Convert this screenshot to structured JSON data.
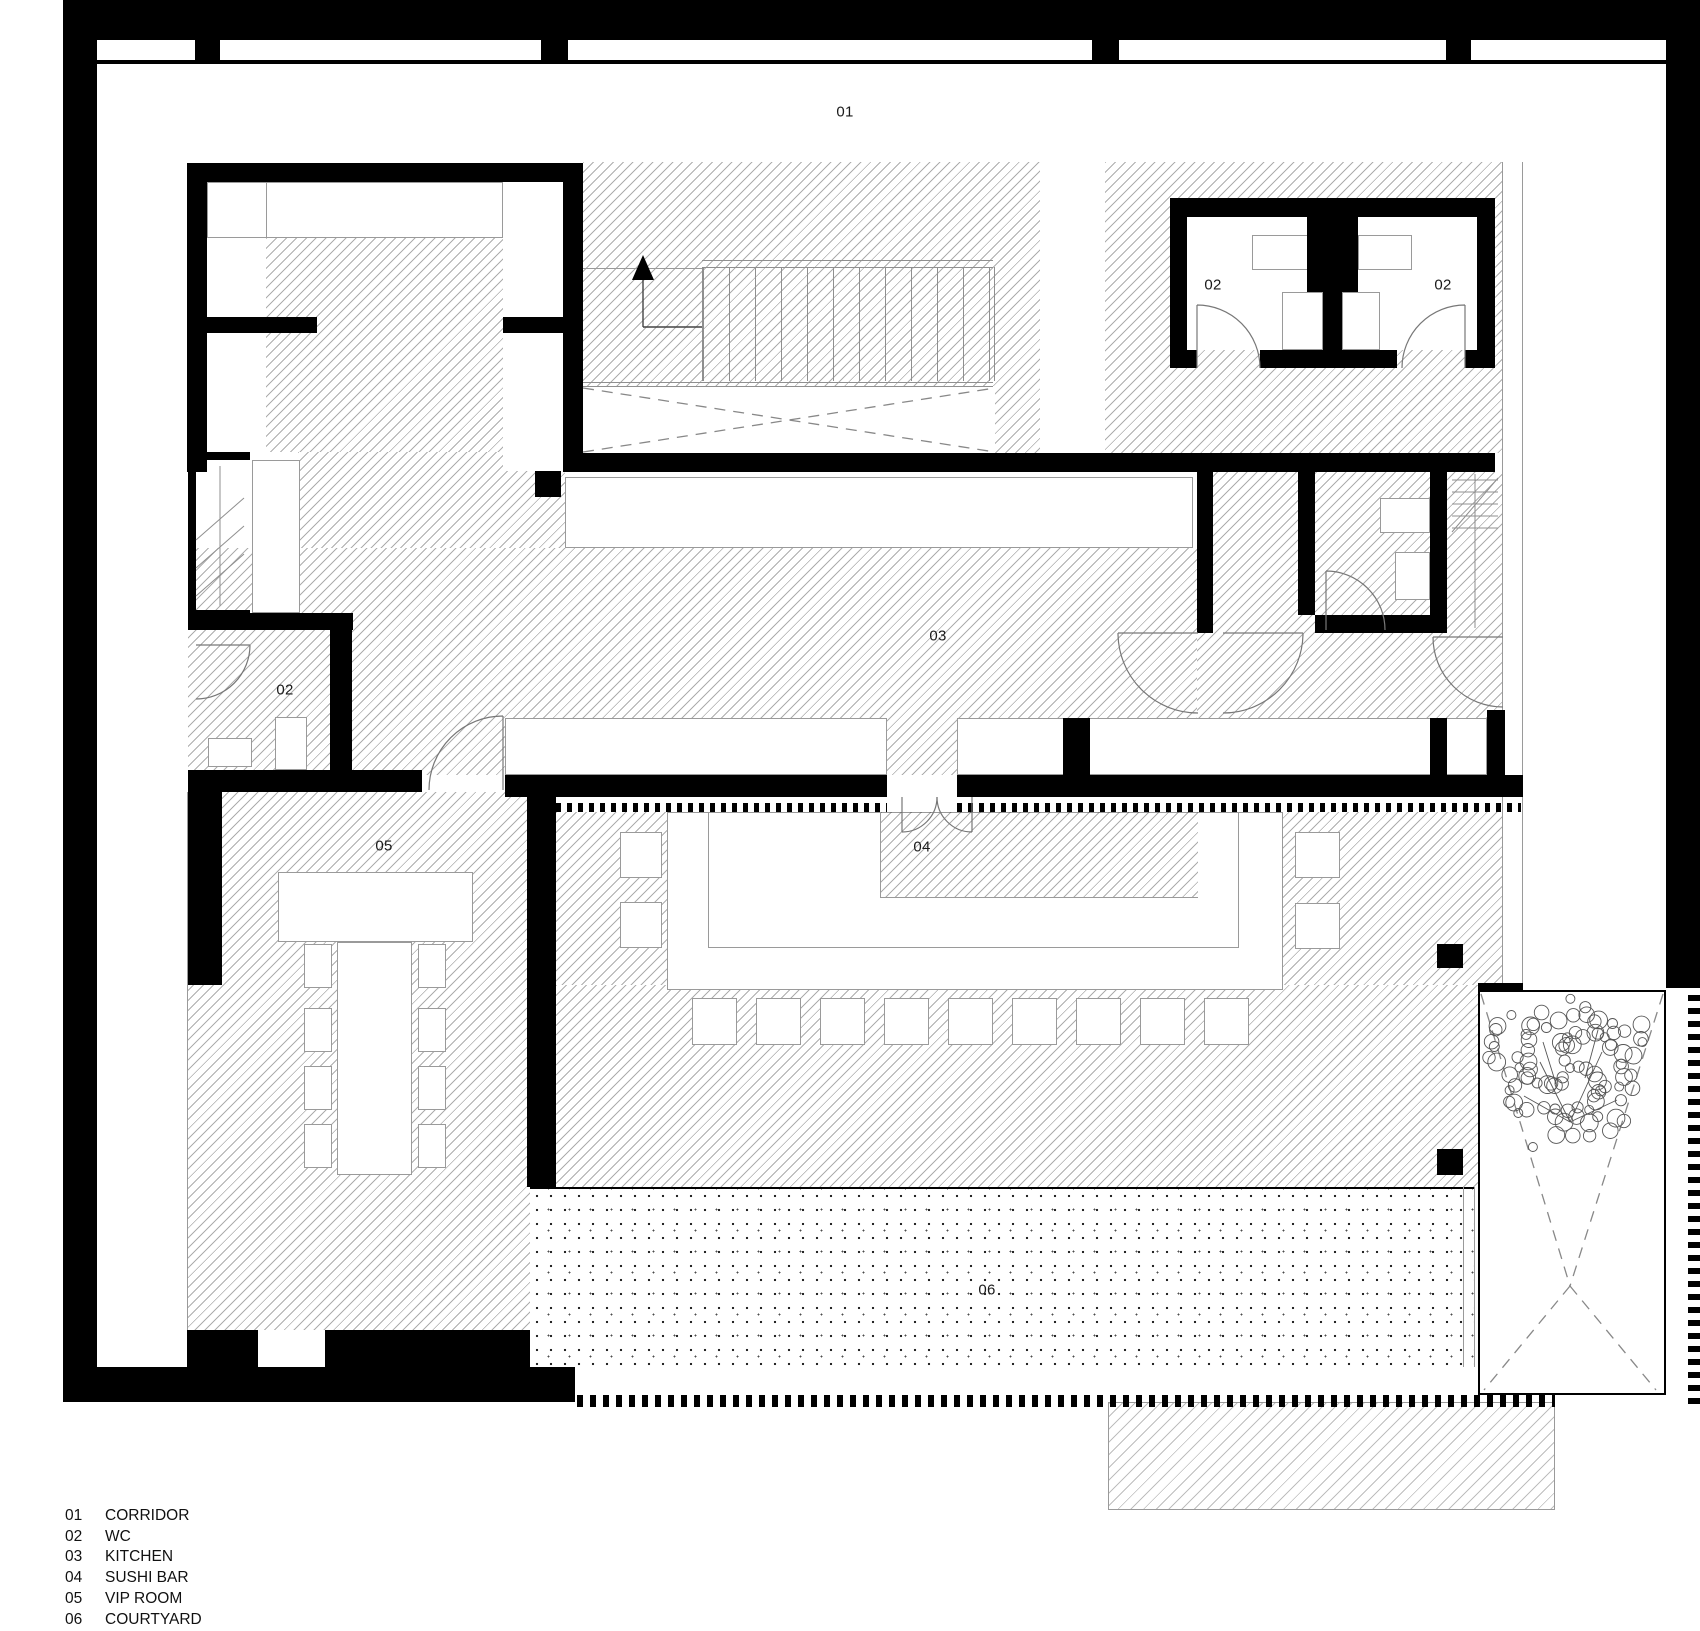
{
  "document": {
    "type": "architectural-floor-plan",
    "plan": {
      "labels": [
        {
          "id": "corridor",
          "text": "01",
          "x": 845,
          "y": 112
        },
        {
          "id": "wc-top-left",
          "text": "02",
          "x": 1213,
          "y": 285
        },
        {
          "id": "wc-top-right",
          "text": "02",
          "x": 1443,
          "y": 285
        },
        {
          "id": "wc-left",
          "text": "02",
          "x": 285,
          "y": 690
        },
        {
          "id": "kitchen",
          "text": "03",
          "x": 938,
          "y": 636
        },
        {
          "id": "sushi-bar",
          "text": "04",
          "x": 922,
          "y": 847
        },
        {
          "id": "vip-room",
          "text": "05",
          "x": 384,
          "y": 846
        },
        {
          "id": "courtyard",
          "text": "06",
          "x": 987,
          "y": 1290
        }
      ],
      "features": [
        "stair-run-with-up-arrow",
        "void-dashed-x",
        "door-swing-arcs",
        "tree-in-planter",
        "sushi-u-counter-with-stools",
        "vip-long-table-with-8-chairs",
        "wc-fixtures"
      ]
    },
    "legend": {
      "rows": [
        {
          "num": "01",
          "label": "CORRIDOR"
        },
        {
          "num": "02",
          "label": "WC"
        },
        {
          "num": "03",
          "label": "KITCHEN"
        },
        {
          "num": "04",
          "label": "SUSHI BAR"
        },
        {
          "num": "05",
          "label": "VIP ROOM"
        },
        {
          "num": "06",
          "label": "COURTYARD"
        }
      ]
    },
    "colors": {
      "wall": "#000000",
      "hatch_line": "#8f8f8f",
      "outline": "#9a9a9a",
      "dash": "#888888",
      "paper": "#ffffff"
    }
  }
}
